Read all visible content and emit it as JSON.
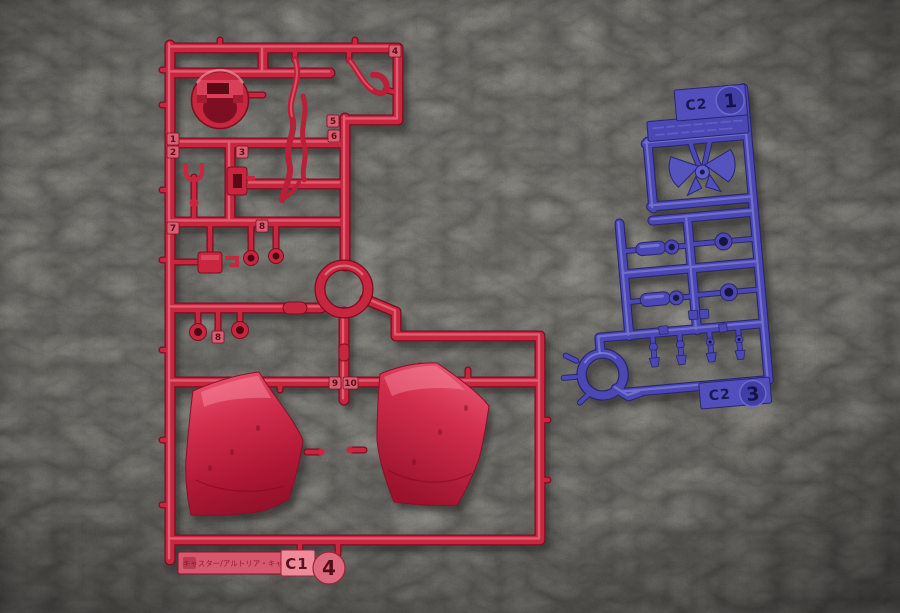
{
  "background": {
    "leather_color": "#3a3833",
    "vignette_color": "#1c1b18"
  },
  "red_sprue": {
    "plastic_color": "#c6273f",
    "highlight_color": "#ff9eb0",
    "shadow_color": "#7c0d20",
    "runner_code": "C1",
    "runner_number": "4",
    "name_plate_text": "キャスター/アルトリア・キャスター",
    "part_tags": [
      "1",
      "2",
      "3",
      "4",
      "5",
      "6",
      "7",
      "8",
      "8",
      "9",
      "10"
    ]
  },
  "blue_sprue": {
    "plastic_color": "#4b48b4",
    "highlight_color": "#a0a0ee",
    "shadow_color": "#28276e",
    "top_tag": {
      "code": "C2",
      "number": "1"
    },
    "bottom_tag": {
      "code": "C2",
      "number": "3"
    }
  }
}
